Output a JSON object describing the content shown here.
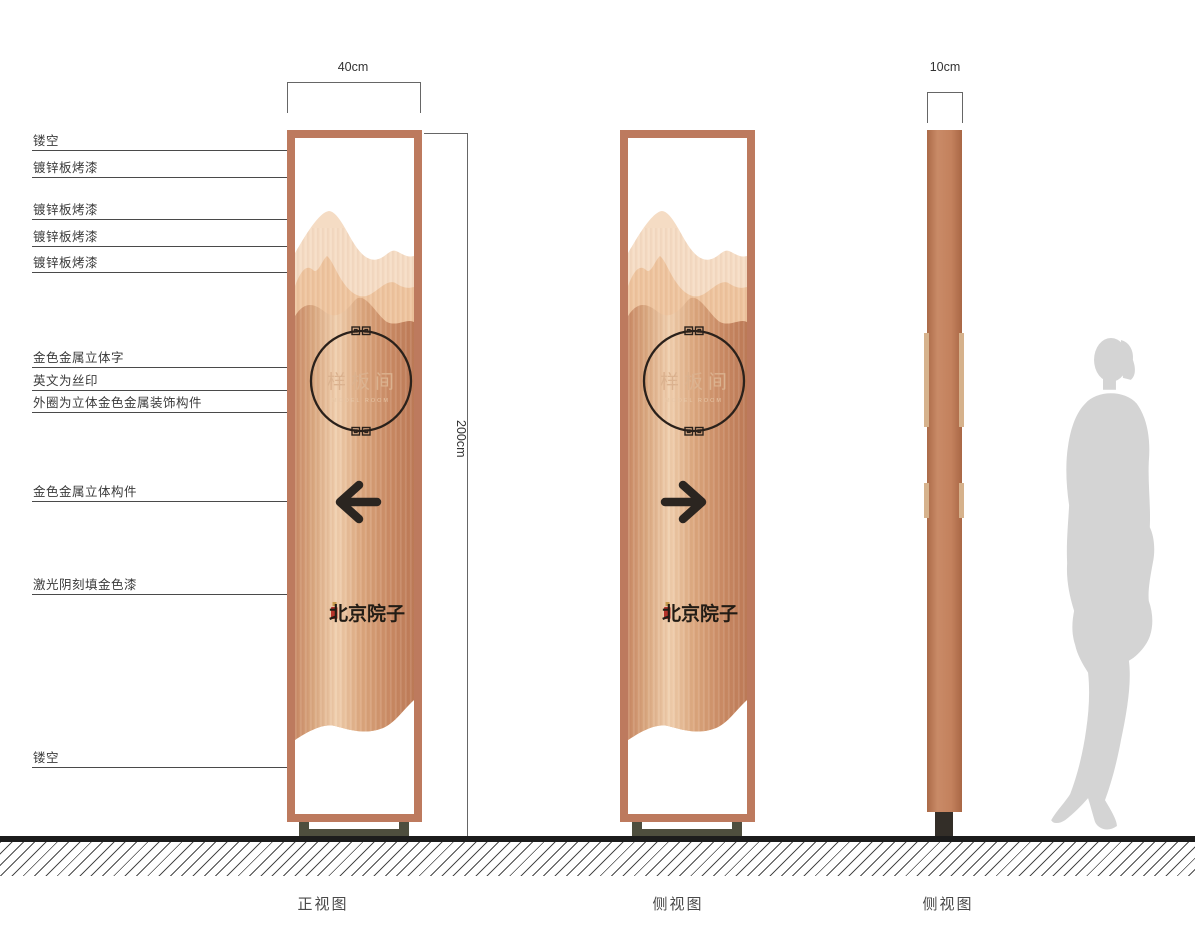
{
  "drawing": {
    "dimensions": {
      "width_front": "40cm",
      "height": "200cm",
      "depth": "10cm"
    },
    "captions": {
      "front": "正视图",
      "side1": "侧视图",
      "side2": "侧视图"
    },
    "sign": {
      "room_name": "样板间",
      "room_name_en": "MODEL ROOM",
      "brand": "北京院子"
    },
    "callouts": [
      {
        "label": "镂空"
      },
      {
        "label": "镀锌板烤漆"
      },
      {
        "label": "镀锌板烤漆"
      },
      {
        "label": "镀锌板烤漆"
      },
      {
        "label": "镀锌板烤漆"
      },
      {
        "label": "金色金属立体字"
      },
      {
        "label": "英文为丝印"
      },
      {
        "label": "外圈为立体金色金属装饰构件"
      },
      {
        "label": "金色金属立体构件"
      },
      {
        "label": "激光阴刻填金色漆"
      },
      {
        "label": "镂空"
      }
    ],
    "colors": {
      "frame_copper": "#bd7a5e",
      "panel_highlight": "#f0cfae",
      "panel_base": "#c98a66",
      "mountain_light": "#f5dcc4",
      "mountain_mid": "#eec49e",
      "ink": "#2b2520",
      "gold_text": "#dbb28f",
      "seal_red": "#b5332a",
      "base_olive": "#4e4e3e",
      "silhouette_gray": "#d4d4d4"
    }
  }
}
